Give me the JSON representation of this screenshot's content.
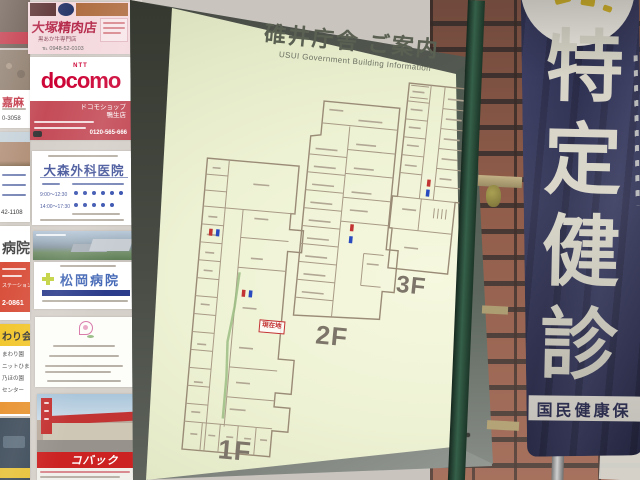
{
  "board": {
    "title": "碓井庁舎 ご案内",
    "subtitle": "USUI  Government  Building  Information",
    "floors": [
      {
        "label": "1F"
      },
      {
        "label": "2F"
      },
      {
        "label": "3F"
      }
    ],
    "you_are_here": "現在地",
    "face_color": "#eef2d4",
    "frame_color": "#555a53"
  },
  "banner": {
    "chars": [
      "特",
      "定",
      "健",
      "診"
    ],
    "strip": "国民健康保",
    "navy": "#303253",
    "text_color": "#d8d5c8"
  },
  "ads": {
    "butcher": {
      "name": "大塚精肉店",
      "sub": "黒あか牛専門店",
      "phone": "℡ 0948-52-0103"
    },
    "docomo": {
      "ntt": "NTT",
      "brand": "docomo",
      "shop": "ドコモショップ\n鴨生店",
      "phone": "0120-565-666",
      "red": "#c44c58"
    },
    "omori": {
      "name": "大森外科医院",
      "hours1": "9:00～12:30",
      "hours2": "14:00～17:30"
    },
    "matsuoka": {
      "name": "松岡病院"
    },
    "kobac": {
      "name": "コバック"
    },
    "left_column": {
      "phone_top": "43-0058",
      "kama": "嘉麻",
      "phone_kama": "0-3058",
      "phone_clinic": "42-1108",
      "hospital": "病院",
      "station": "ステーション",
      "phone_hosp": "2-0861",
      "wari": "わり会",
      "items": [
        "まわり園",
        "ニットひまわり",
        "乃ほの園",
        "センター"
      ]
    }
  }
}
